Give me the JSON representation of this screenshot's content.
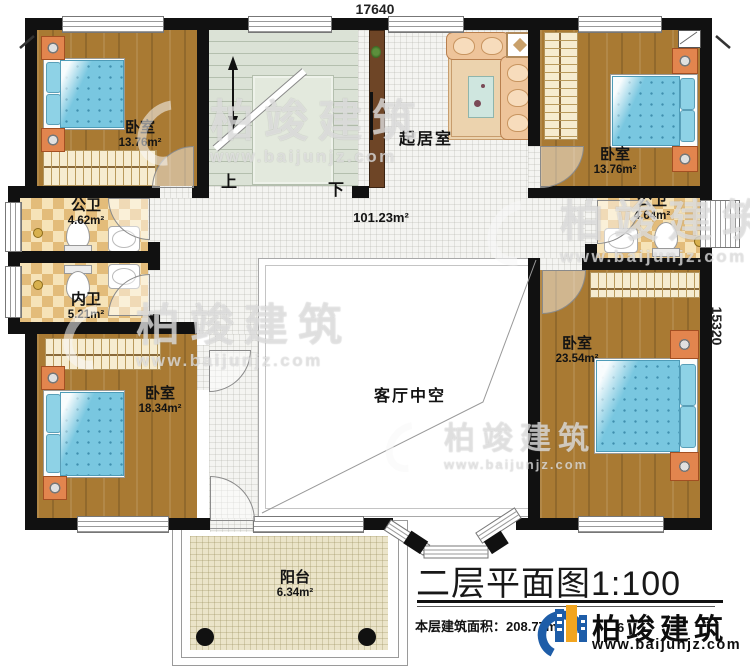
{
  "dimensions": {
    "top": "17640",
    "right": "15320"
  },
  "stairs": {
    "up": "上",
    "down": "下"
  },
  "rooms": {
    "bedroom_tl": {
      "name": "卧室",
      "area": "13.76m²"
    },
    "bedroom_tr": {
      "name": "卧室",
      "area": "13.76m²"
    },
    "bedroom_bl": {
      "name": "卧室",
      "area": "18.34m²"
    },
    "bedroom_br": {
      "name": "卧室",
      "area": "23.54m²"
    },
    "bath_public_left": {
      "name": "公卫",
      "area": "4.62m²"
    },
    "bath_private_left": {
      "name": "内卫",
      "area": "5.21m²"
    },
    "bath_public_right": {
      "name": "公卫",
      "area": "4.64m²"
    },
    "living_room": {
      "name": "起居室"
    },
    "hall": {
      "area": "101.23m²"
    },
    "void": {
      "name": "客厅中空"
    },
    "balcony": {
      "name": "阳台",
      "area": "6.34m²"
    }
  },
  "title": {
    "text": "二层平面图",
    "scale": "1:100"
  },
  "footer": {
    "area_label": "本层建筑面积：",
    "area_value": "208.77m²",
    "obscured_fragment": "6"
  },
  "brand": {
    "name": "柏竣建筑",
    "url": "www.baijunjz.com"
  },
  "watermark": {
    "name": "柏竣建筑",
    "url": "www.baijunjz.com"
  },
  "colors": {
    "wall": "#111111",
    "wood": "#a97a33",
    "checker_dark": "#e3bc7a",
    "checker_light": "#f6e3b8",
    "stair": "#dbe2d6",
    "balcony_floor": "#ebe4c9",
    "logo_blue": "#1e5da8",
    "logo_orange": "#f2a51f"
  }
}
